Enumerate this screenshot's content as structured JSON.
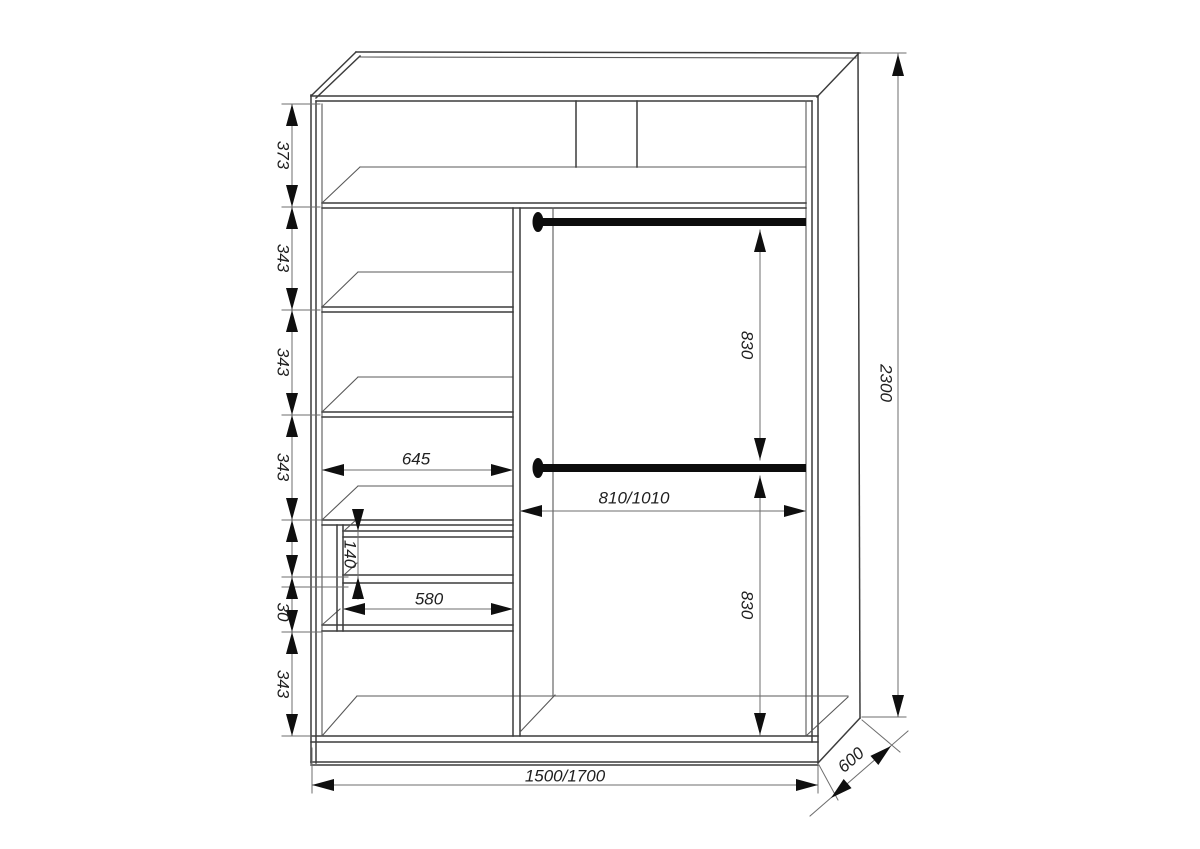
{
  "title": "Wardrobe interior dimension drawing",
  "dims": {
    "left_chain": [
      "373",
      "343",
      "343",
      "343",
      "30",
      "343"
    ],
    "drawer_gap": "140",
    "shelf_width": "645",
    "drawer_width": "580",
    "hang_section_width": "810/1010",
    "hang_drop_upper": "830",
    "hang_drop_lower": "830",
    "overall_height": "2300",
    "overall_width": "1500/1700",
    "overall_depth": "600"
  }
}
